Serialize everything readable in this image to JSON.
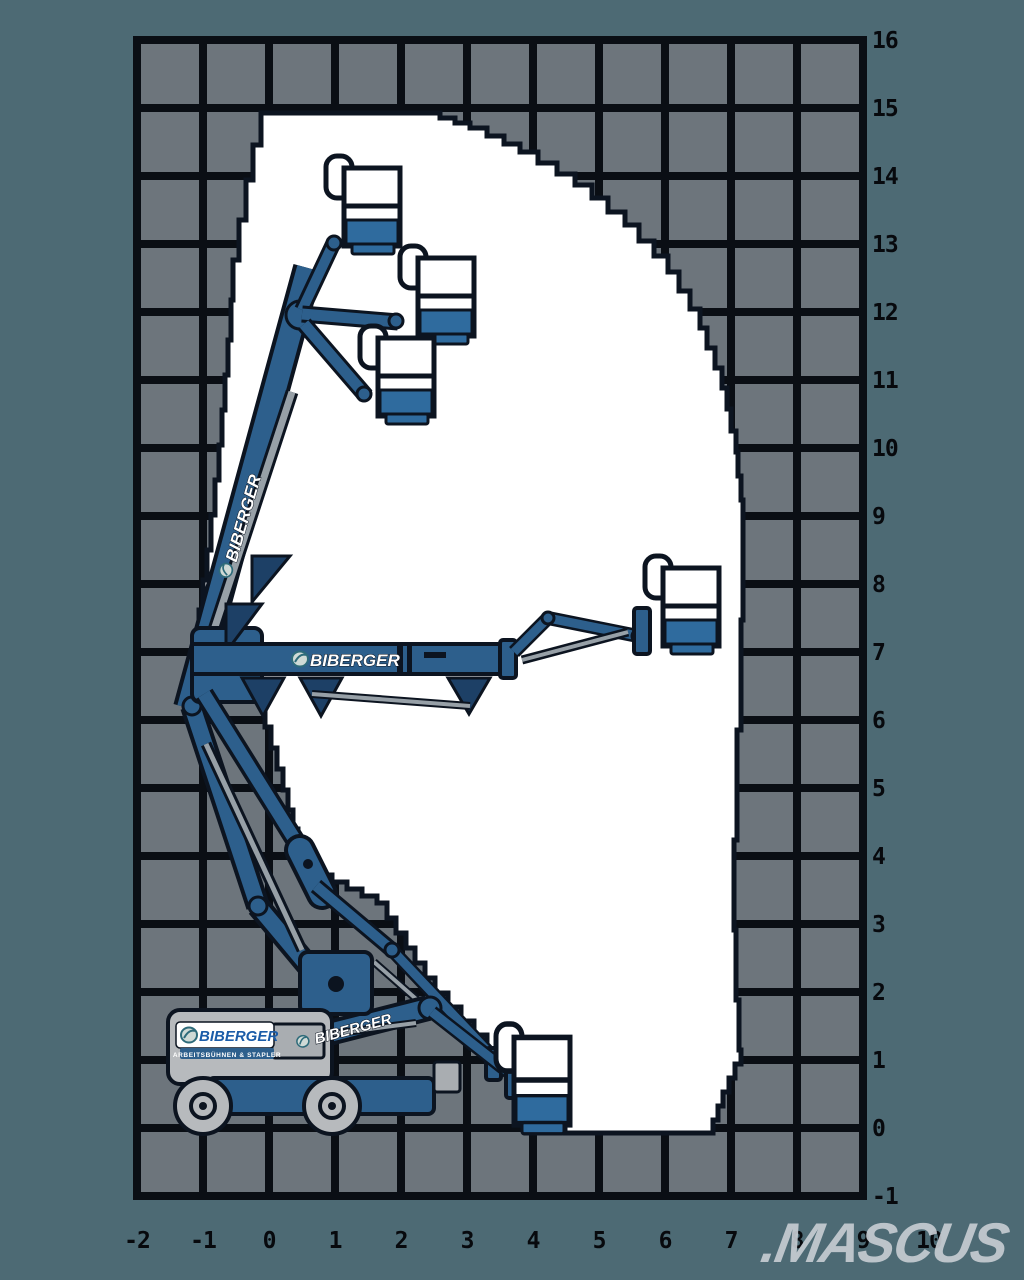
{
  "logos": {
    "machine_body": {
      "text": "BIBERGER",
      "subtext": "ARBEITSBÜHNEN & STAPLER"
    },
    "horizontal_boom": "BIBERGER",
    "vertical_boom": "BIBERGER",
    "low_boom": "BIBERGER"
  },
  "watermark": ".MASCUS",
  "axes": {
    "right": [
      "16",
      "15",
      "14",
      "13",
      "12",
      "11",
      "10",
      "9",
      "8",
      "7",
      "6",
      "5",
      "4",
      "3",
      "2",
      "1",
      "0",
      "-1"
    ],
    "bottom": [
      "-2",
      "-1",
      "0",
      "1",
      "2",
      "3",
      "4",
      "5",
      "6",
      "7",
      "8",
      "9",
      "10"
    ]
  },
  "colors": {
    "background": "#4d6a74",
    "grid_cell": "#6d757c",
    "grid_line": "#0a0e14",
    "envelope_fill": "#ffffff",
    "outline": "#0c1420",
    "machine_blue": "#2d5f8c",
    "machine_blue_dark": "#1d4066",
    "machine_silver": "#97a0a7",
    "machine_gray": "#b7babd",
    "basket_tray_blue": "#2f6b9e",
    "logo_blue": "#1b5ca8",
    "watermark_color": "#c6ccd2",
    "axis_text": "#07090d"
  }
}
